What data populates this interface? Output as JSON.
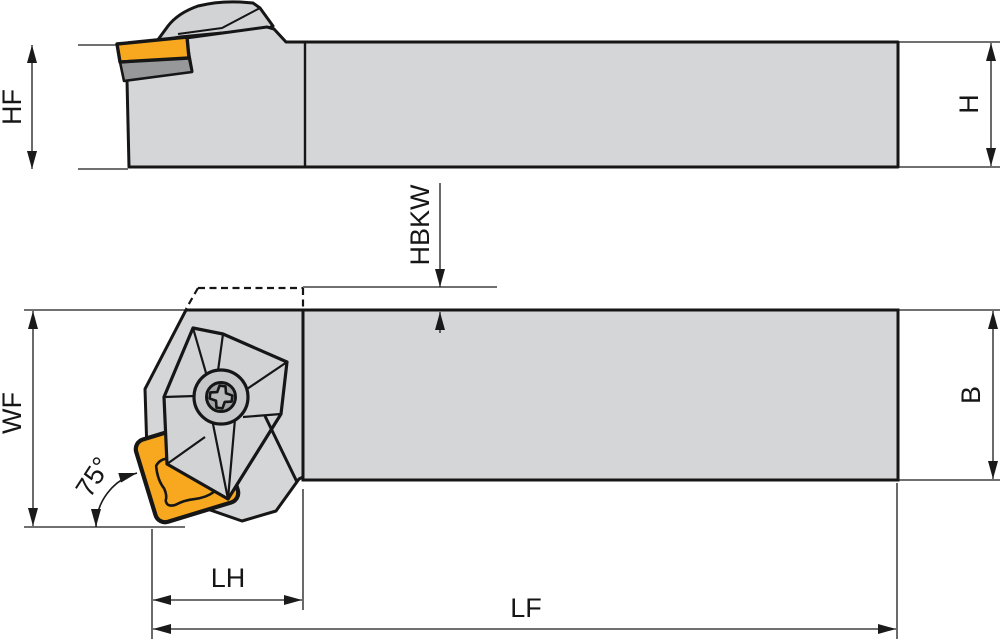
{
  "labels": {
    "hf": "HF",
    "h": "H",
    "hbkw": "HBKW",
    "wf": "WF",
    "b": "B",
    "angle": "75°",
    "lh": "LH",
    "lf": "LF"
  },
  "colors": {
    "background": "#FFFFFF",
    "body": "#D5D6D8",
    "clamp": "#D2D3D5",
    "insert": "#F7A81E",
    "shim": "#97989A",
    "screw_ring": "#C7C8CA",
    "screw_inner": "#A3A4A6",
    "screw_star": "#BABBBD",
    "outline": "#161616",
    "dim_line": "#1A1A1A"
  }
}
